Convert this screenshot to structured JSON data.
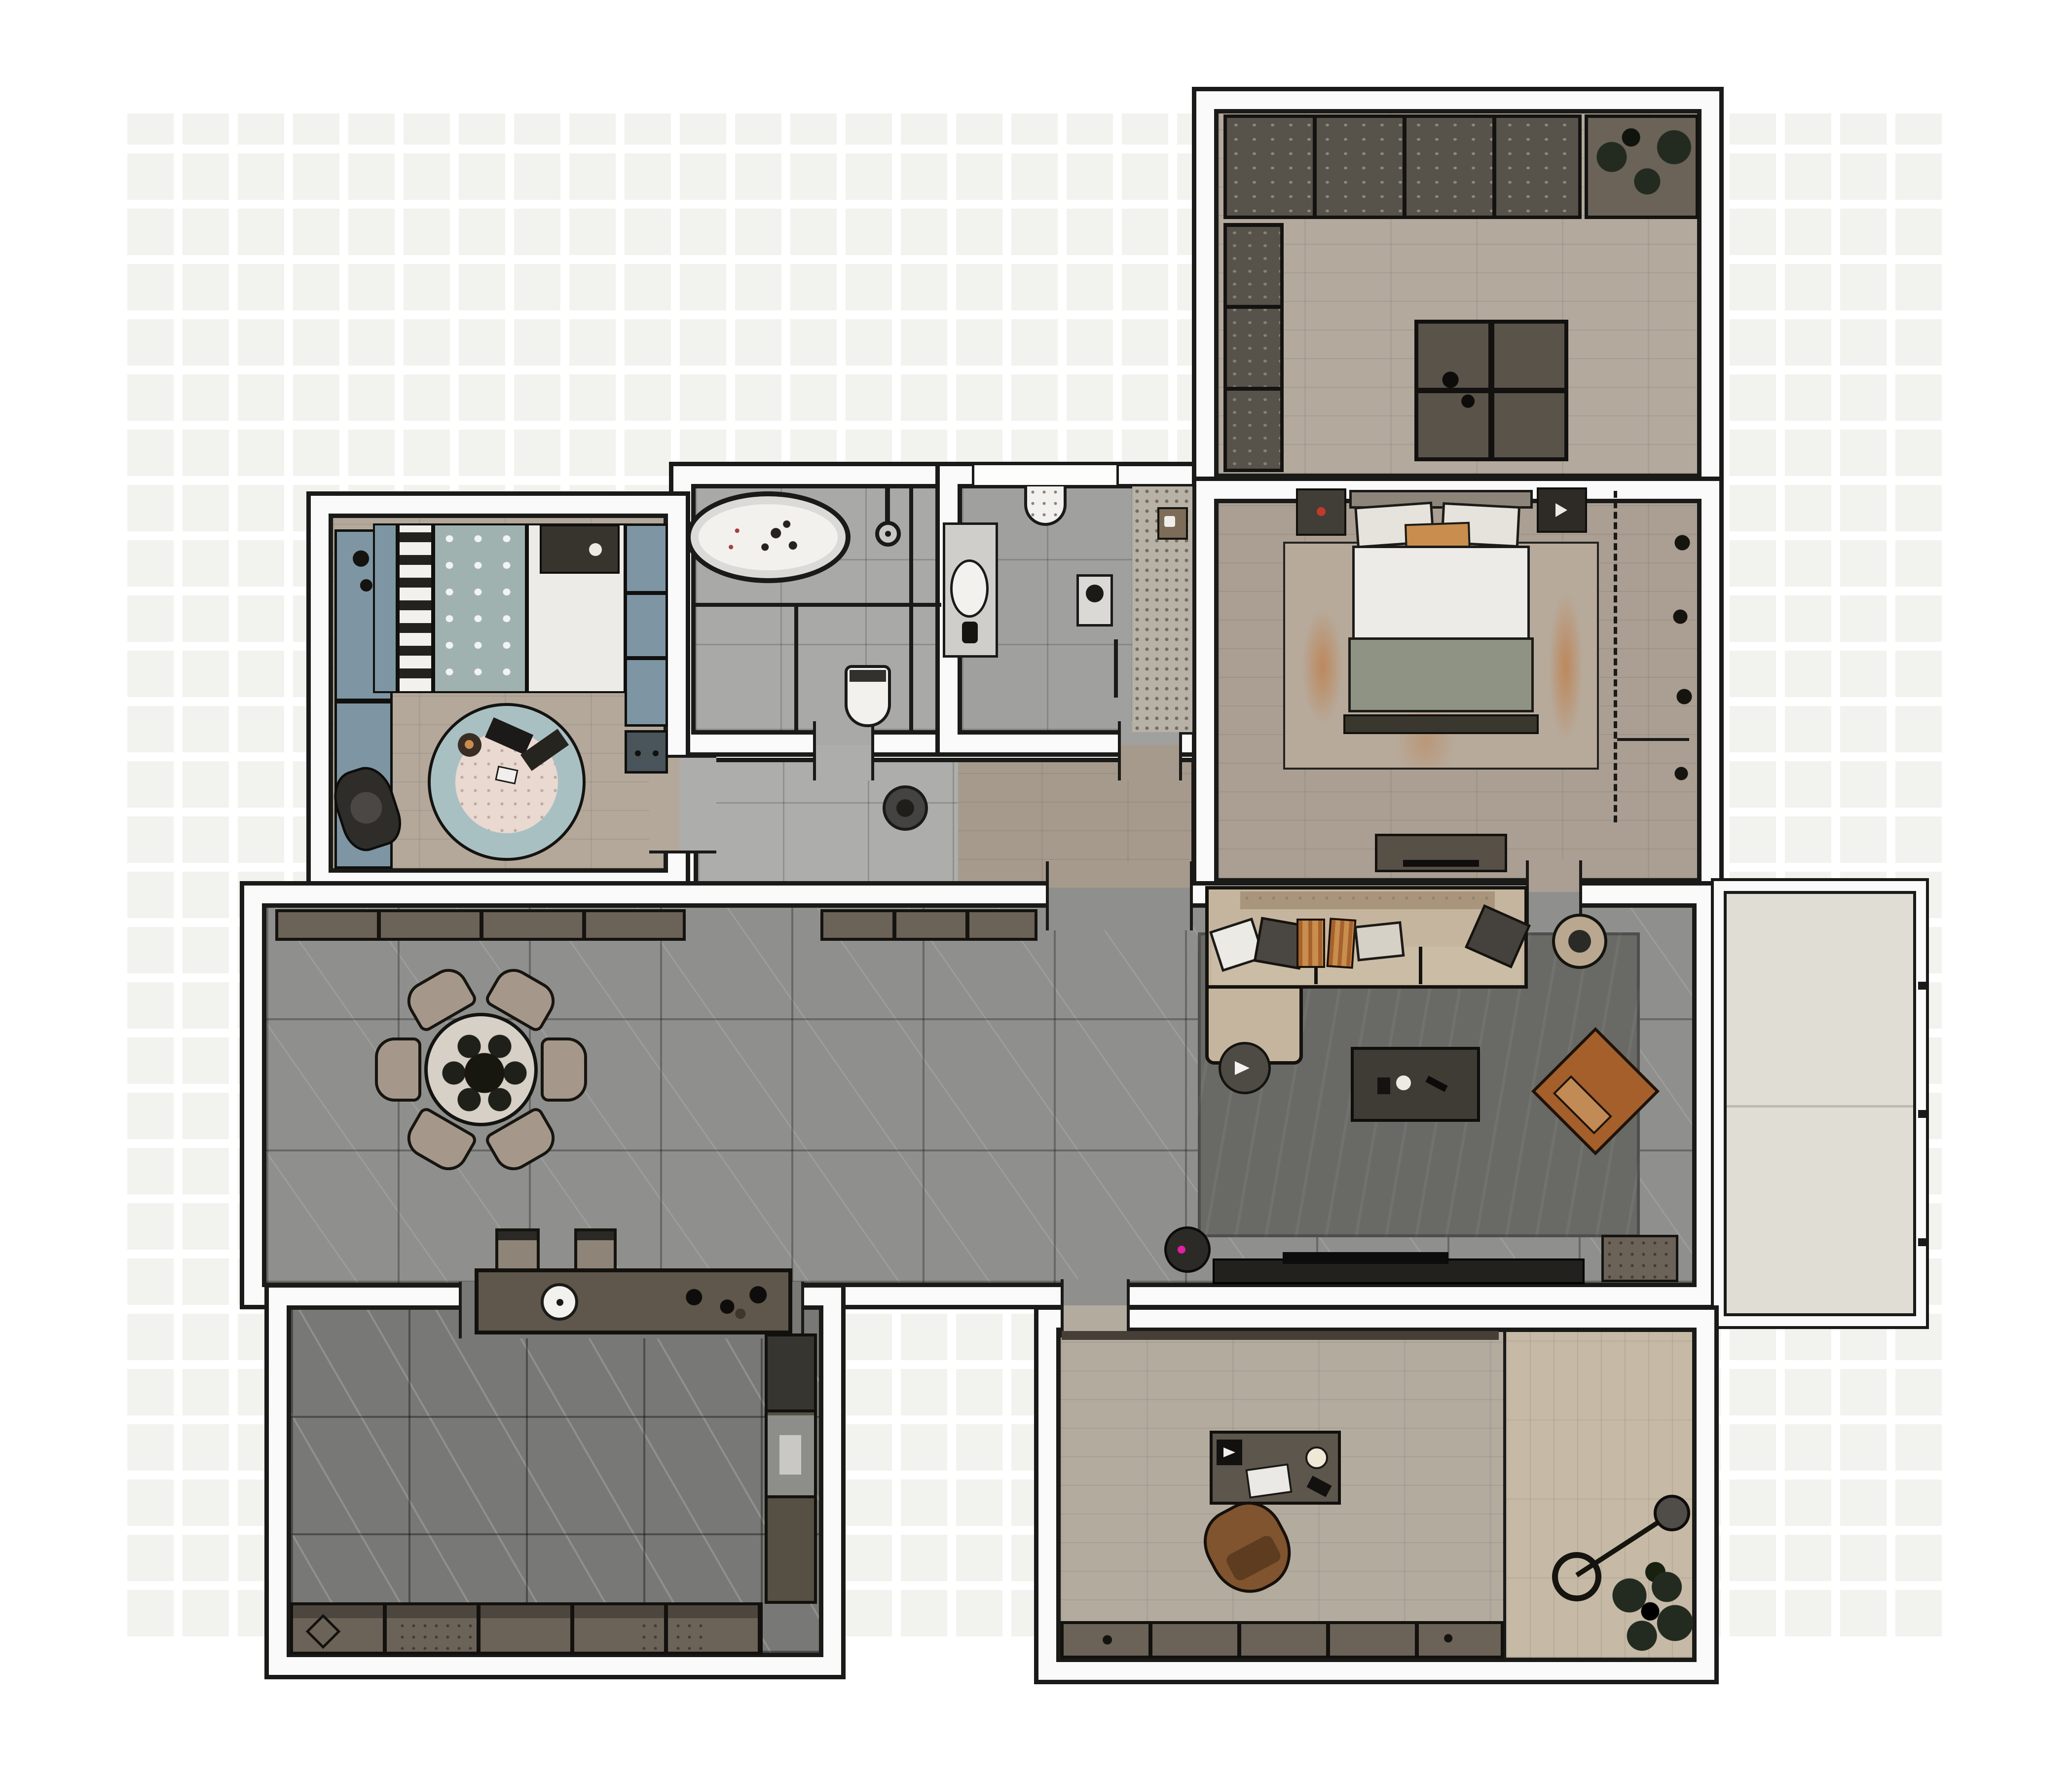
{
  "scene": {
    "type": "floor-plan-render",
    "view": "top-down",
    "visible_text": "none"
  },
  "colors": {
    "page_bg": "#ffffff",
    "checker": "#f2f2ef",
    "wall_fill": "#fafafa",
    "line": "#1a1a18",
    "wood_closet": "#b3a99d",
    "wood_bedroom": "#ab9f93",
    "wood_kids": "#b3a89a",
    "wood_hall": "#a69a8c",
    "wood_study": "#b4ab9f",
    "wood_entry": "#c6baa6",
    "tile_living": "#8f8f8d",
    "tile_hall": "#adadab",
    "tile_bath": "#a9a9a7",
    "tile_wc": "#a0a09e",
    "tile_kitchen": "#787876",
    "balcony_floor": "#e0ded4",
    "cabinet_dark": "#57524a",
    "cabinet_brown": "#6b6258",
    "island_closet": "#59534a",
    "counter_kitchen": "#5f574c",
    "sofa": "#c6b59e",
    "sofa_rail": "#a8957b",
    "sofa_seat": "#cbbca6",
    "rug_living": "#696966",
    "rug_bedroom": "#b7aa9b",
    "rug_accent_orange": "#c1702a",
    "coffee_table": "#3f3c36",
    "armchair": "#a45f2a",
    "armchair_cushion": "#c28a55",
    "pouf": "#4e4b45",
    "bed_linen": "#ecebe7",
    "bed_throw": "#8e9383",
    "headboard": "#8d8579",
    "pillow_orange": "#c98d4e",
    "teal_panel": "#7e96a3",
    "teal_duvet": "#9fb2af",
    "rug_kids_ring": "#a9c0c3",
    "rug_kids_center": "#ead9d0",
    "chair_tan": "#a5988a",
    "table_top": "#d6d0c6",
    "stool": "#8f8478",
    "desk": "#5d564c",
    "office_chair": "#80542e",
    "kids_chair": "#2f2d2a",
    "stone_wall": "#b7b1a6",
    "plant": "#232b20",
    "tv": "#0c0c0c",
    "console_dark": "#23211e",
    "vacuum": "#2c2a27",
    "vacuum_dot": "#e020a0",
    "white_fixture": "#f2f1ee",
    "drain": "#44433f",
    "lamp_head": "#504d49",
    "column_top": "#37352f",
    "column_mid": "#8d8d8a",
    "column_bot": "#564f44",
    "dark_furniture": "#413d37",
    "footbench": "#3a372f"
  },
  "rooms": [
    {
      "label": "walk-in closet with island",
      "furniture": [
        "wall cabinets",
        "corner plant shelf",
        "side cabinets",
        "center island"
      ]
    },
    {
      "label": "master bedroom",
      "furniture": [
        "double bed",
        "nightstands",
        "area rug with orange accents",
        "tv lowboard",
        "wardrobe zone (dashed)"
      ]
    },
    {
      "label": "bathroom",
      "furniture": [
        "oval bathtub",
        "shower fixture",
        "glass partitions",
        "toilet"
      ]
    },
    {
      "label": "shower room",
      "furniture": [
        "corner sink",
        "vanity with basin",
        "wall art",
        "pebble shower wall",
        "door leaf"
      ]
    },
    {
      "label": "kids bedroom",
      "furniture": [
        "desk counter",
        "desk chair",
        "single bed with dotted duvet",
        "round play rug",
        "wardrobe",
        "dresser"
      ]
    },
    {
      "label": "hallway",
      "furniture": [
        "floor drain disc"
      ]
    },
    {
      "label": "living dining room",
      "furniture": [
        "sideboards",
        "round dining table",
        "six dining chairs",
        "two bar stools",
        "corner sofa",
        "throw pillows",
        "side table",
        "dark rug",
        "coffee table",
        "pouf",
        "lounge armchair",
        "tv lowboard",
        "tv",
        "robot vacuum",
        "media cabinet"
      ]
    },
    {
      "label": "balcony",
      "furniture": [
        "railing"
      ]
    },
    {
      "label": "kitchen",
      "furniture": [
        "island with sink",
        "tall cabinet column",
        "base cabinet run",
        "hob diamond"
      ]
    },
    {
      "label": "home office with entry",
      "furniture": [
        "desk with lamp and laptop",
        "office chair",
        "sideboard",
        "arc floor lamp",
        "potted plant"
      ]
    }
  ]
}
